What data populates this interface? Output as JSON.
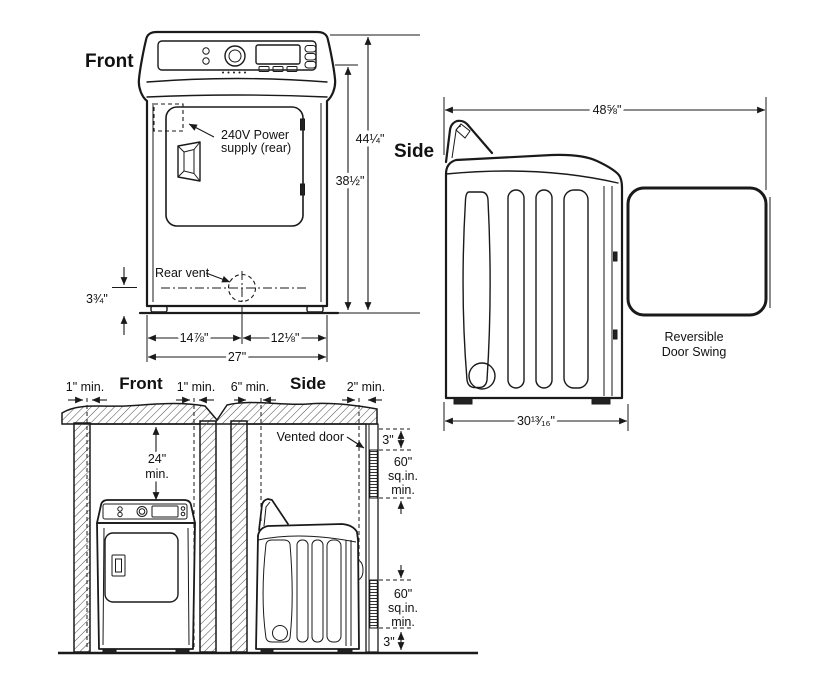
{
  "figure": {
    "front": {
      "title": "Front",
      "power_l1": "240V Power",
      "power_l2": "supply (rear)",
      "rear_vent": "Rear vent",
      "dim_total_height": "44¼\"",
      "dim_body_height": "38½\"",
      "dim_vent_floor": "3¾\"",
      "dim_width_left": "14⅞\"",
      "dim_width_right": "12⅛\"",
      "dim_width_total": "27\""
    },
    "side": {
      "title": "Side",
      "dim_depth_door_open": "48⅝\"",
      "dim_depth": "30¹³⁄₁₆\"",
      "door_swing_l1": "Reversible",
      "door_swing_l2": "Door Swing"
    },
    "clearance": {
      "front_title": "Front",
      "side_title": "Side",
      "gap_front_left": "1\" min.",
      "gap_front_right": "1\" min.",
      "gap_side_rear": "6\" min.",
      "gap_side_front": "2\" min.",
      "above_l1": "24\"",
      "above_l2": "min.",
      "vented_door": "Vented door",
      "vent_top_gap": "3\"",
      "vent_top_l1": "60\"",
      "vent_top_l2": "sq.in.",
      "vent_top_l3": "min.",
      "vent_bot_l1": "60\"",
      "vent_bot_l2": "sq.in.",
      "vent_bot_l3": "min.",
      "vent_bot_gap": "3\""
    }
  }
}
